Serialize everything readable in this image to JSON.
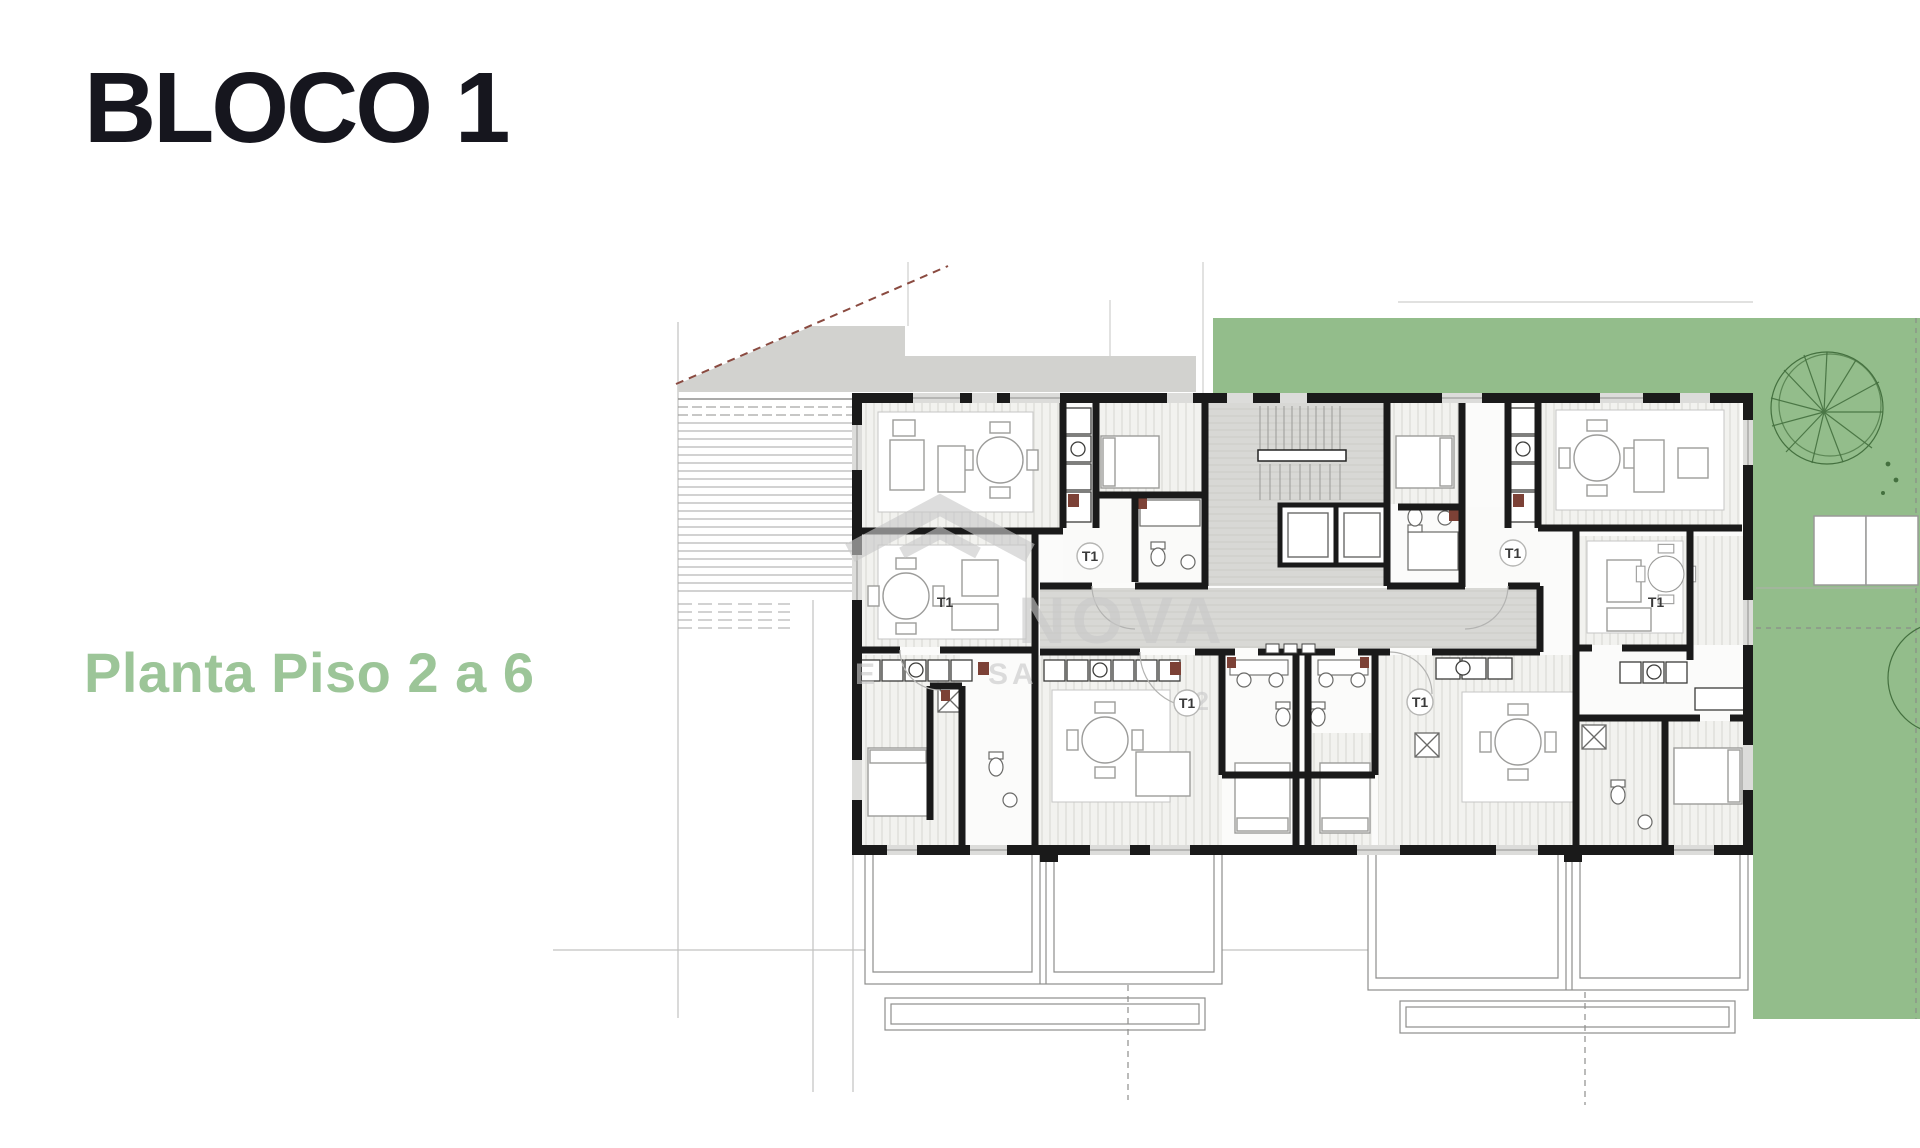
{
  "title": {
    "text": "BLOCO 1",
    "color": "#16161e"
  },
  "subtitle": {
    "text": "Planta Piso 2 a 6",
    "color": "#9cc598"
  },
  "plan": {
    "unit_labels": [
      {
        "text": "T1",
        "unit": "upper-left",
        "circled": true
      },
      {
        "text": "T1",
        "unit": "mid-left",
        "circled": false
      },
      {
        "text": "T1",
        "unit": "upper-right",
        "circled": true
      },
      {
        "text": "T1",
        "unit": "far-right",
        "circled": false
      },
      {
        "text": "T1",
        "unit": "lower-center-left",
        "circled": true
      },
      {
        "text": "T1",
        "unit": "lower-center-right",
        "circled": true
      }
    ],
    "watermark": {
      "brand": "NOVA",
      "frag_left": "E",
      "frag_mid": "SA",
      "frag_right": "42"
    },
    "colors": {
      "garden_green": "#93bd8b",
      "road_gray": "#d2d2cf",
      "core_gray": "#d8d8d5",
      "wall_black": "#1a1a1a",
      "tree_green": "#44703f",
      "boundary_red": "#8a4a40",
      "appliance_red": "#7c4136",
      "watermark_gray": "#c9c9c9"
    }
  }
}
